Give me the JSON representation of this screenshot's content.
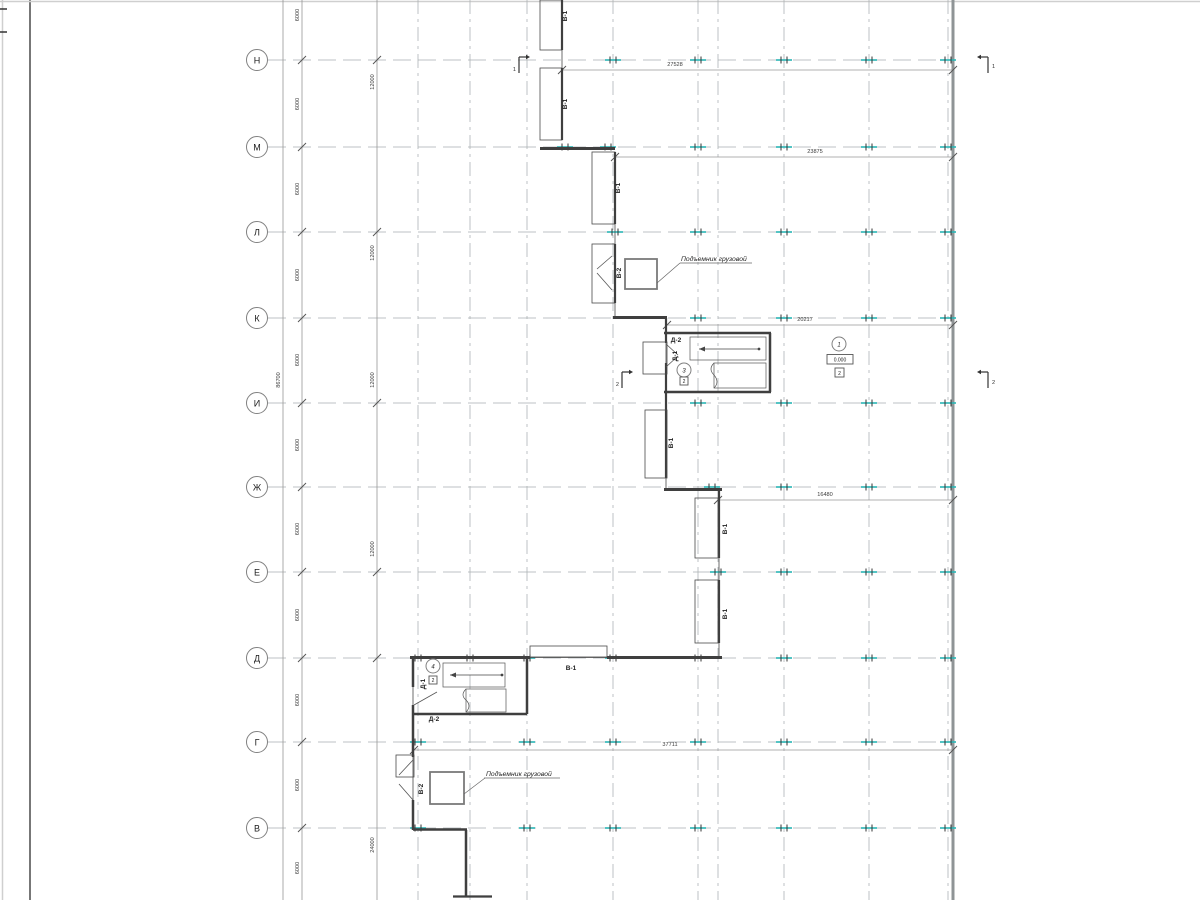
{
  "drawing": {
    "axis_rows": [
      "Н",
      "М",
      "Л",
      "К",
      "И",
      "Ж",
      "Е",
      "Д",
      "Г",
      "В"
    ],
    "dims": {
      "bay": "6000",
      "double_bay": "12000",
      "quad_bay": "24000",
      "total_vertical": "86700",
      "row_n": "27528",
      "row_m": "23875",
      "row_k": "20217",
      "row_zh": "16480",
      "row_g": "37711"
    },
    "marks": {
      "gate1": "В-1",
      "gate2": "В-2",
      "door1": "Д-1",
      "door2": "Д-2"
    },
    "rooms": {
      "hall": "1",
      "stair_upper": "3",
      "stair_lower": "4"
    },
    "floor_type": "2",
    "elevation": "0.000",
    "sections": {
      "s1": "1",
      "s2": "2"
    },
    "lift_callout": "Подъемник грузовой",
    "colors": {
      "column_tick": "#29b5b5",
      "wall": "#3f3f3f",
      "grid": "#a9aeb1",
      "dimension": "#969696"
    }
  }
}
